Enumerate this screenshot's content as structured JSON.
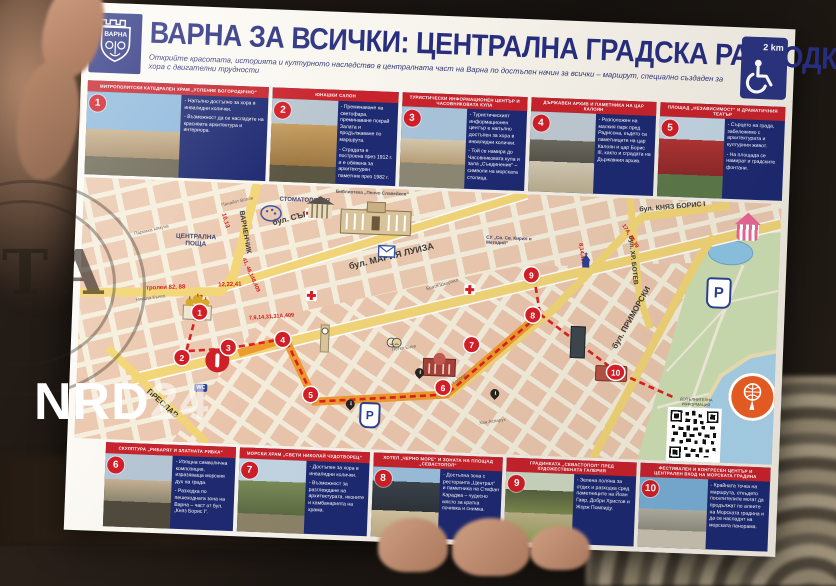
{
  "watermarks": {
    "news_agency_partial": "ТА",
    "channel": "NRD",
    "channel_number": "24"
  },
  "header": {
    "municipality_logo_text": "ВАРНА",
    "title": "ВАРНА ЗА ВСИЧКИ: ЦЕНТРАЛНА ГРАДСКА РАЗХОДКА",
    "subtitle": "Открийте красотата, историята и културното наследство в централната част на Варна по достъпен начин за всички – маршрут, специално създаден за хора с двигателни трудности",
    "route_length_badge": "2 km"
  },
  "stops_top": [
    {
      "number": "1",
      "title": "МИТРОПОЛИТСКИ КАТЕДРАЛЕН ХРАМ „УСПЕНИЕ БОГОРОДИЧНО“",
      "bullets": [
        "- Напълно достъпно за хора в инвалидни колички.",
        "- Възможност да се насладите на красивата архитектура и интериора."
      ]
    },
    {
      "number": "2",
      "title": "ЮНАШКИ САЛОН",
      "bullets": [
        "- Преминаване на светофара, преминаване покрай Залата и продължаване по маршрута.",
        "- Сградата е построена през 1912 г. и е обявена за архитектурен паметник през 1982 г."
      ]
    },
    {
      "number": "3",
      "title": "ТУРИСТИЧЕСКИ ИНФОРМАЦИОНЕН ЦЕНТЪР И ЧАСОВНИКОВАТА КУЛА",
      "bullets": [
        "- Туристическият информационен център е напълно достъпен за хора в инвалидни колички.",
        "- Той се намира до Часовниковата кула и зала „Съединение“ – символи на морската столица."
      ]
    },
    {
      "number": "4",
      "title": "ДЪРЖАВЕН АРХИВ И ПАМЕТНИКА НА ЦАР КАЛОЯН",
      "bullets": [
        "- Разположен на малкия парк пред Радисона, където са паметниците на цар Калоян и цар Борис III, както и сградата на Държавния архив."
      ]
    },
    {
      "number": "5",
      "title": "ПЛОЩАД „НЕЗАВИСИМОСТ“ И ДРАМАТИЧНИЯ ТЕАТЪР",
      "bullets": [
        "- Сърцето на града, забележимо с архитектурата и културния живот.",
        "- На площада се намират и градските фонтани."
      ]
    }
  ],
  "stops_bottom": [
    {
      "number": "6",
      "title": "СКУЛПТУРА „РИБАРЯТ И ЗЛАТНАТА РИБКА“",
      "bullets": [
        "- Изящна символична композиция, изразяваща морския дух на града.",
        "- Разходка по пешеходната зона на Варна – част от бул. „Княз Борис I“."
      ]
    },
    {
      "number": "7",
      "title": "МОРСКИ ХРАМ „СВЕТИ НИКОЛАЙ ЧУДОТВОРЕЦ“",
      "bullets": [
        "- Достъпен за хора в инвалидни колички.",
        "- Възможност за разглеждане на архитектурата, иконите и камбанарията на храма."
      ]
    },
    {
      "number": "8",
      "title": "ХОТЕЛ „ЧЕРНО МОРЕ“ И ЗОНАТА НА ПЛОЩАД „СЕВАСТОПОЛ“",
      "bullets": [
        "- Достъпна зона с ресторанта „Централ“ и паметника на Стефан Караджа – чудесно място за кратка почивка и снимка."
      ]
    },
    {
      "number": "9",
      "title": "ГРАДИНКАТА „СЕВАСТОПОЛ“ ПРЕД ХУДОЖЕСТВЕНАТА ГАЛЕРИЯ",
      "bullets": [
        "- Зелена поляна за отдих и разходка сред паметниците на Йоан Гавр, Добри Христов и Жорж Помпиду."
      ]
    },
    {
      "number": "10",
      "title": "ФЕСТИВАЛЕН И КОНГРЕСЕН ЦЕНТЪР И ЦЕНТРАЛЕН ВХОД НА МОРСКАТА ГРАДИНА",
      "bullets": [
        "- Крайната точка на маршрута, откъдето посетителите могат да продължат по алеите на Морската градина и да се насладят на морската панорама."
      ]
    }
  ],
  "map": {
    "street_labels": [
      "бул. СЪБОРНИ",
      "бул. МАРИЯ ЛУИЗА",
      "бул. КНЯЗ БОРИС I",
      "бул. ПРИМОРСКИ",
      "ПРЕСЛАВ",
      "ВАРНЕНЧИК",
      "бул. ХР. БОТЕВ"
    ],
    "minor_streets": [
      "Панайот Волов",
      "Парижка комуна",
      "Никола Кънев",
      "Петко Енев",
      "Михаил Колони",
      "Хан Аспарух",
      "Братя Шкорпил"
    ],
    "place_labels": [
      "ЦЕНТРАЛНА ПОЩА",
      "СТОМАТОЛОГИЯ",
      "СУ „Св. Св. Кирил и Методий“",
      "Библиотека „Пенчо Славейков“"
    ],
    "transit_labels": [
      "тролеи 82, 88",
      "12,22,41",
      "10,13",
      "41, 48,148,409",
      "7,9,14,31,31А,409",
      "17А, 26,39",
      "8,14,409"
    ],
    "markers": [
      "1",
      "2",
      "3",
      "4",
      "5",
      "6",
      "7",
      "8",
      "9",
      "10"
    ],
    "wc_label": "WC",
    "parking_label": "P",
    "info_label": "i",
    "qr_caption": "ДОПЪЛНИТЕЛНА ИНФОРМАЦИЯ"
  },
  "colors": {
    "title_navy": "#272e7e",
    "accent_red": "#c8232c",
    "panel_blue": "#1e2a72",
    "route_orange": "#ef9b30",
    "route_red": "#e02020",
    "map_block": "#eccab1",
    "park_green": "#cfe0b4",
    "sea_blue": "#a9d2ea"
  }
}
